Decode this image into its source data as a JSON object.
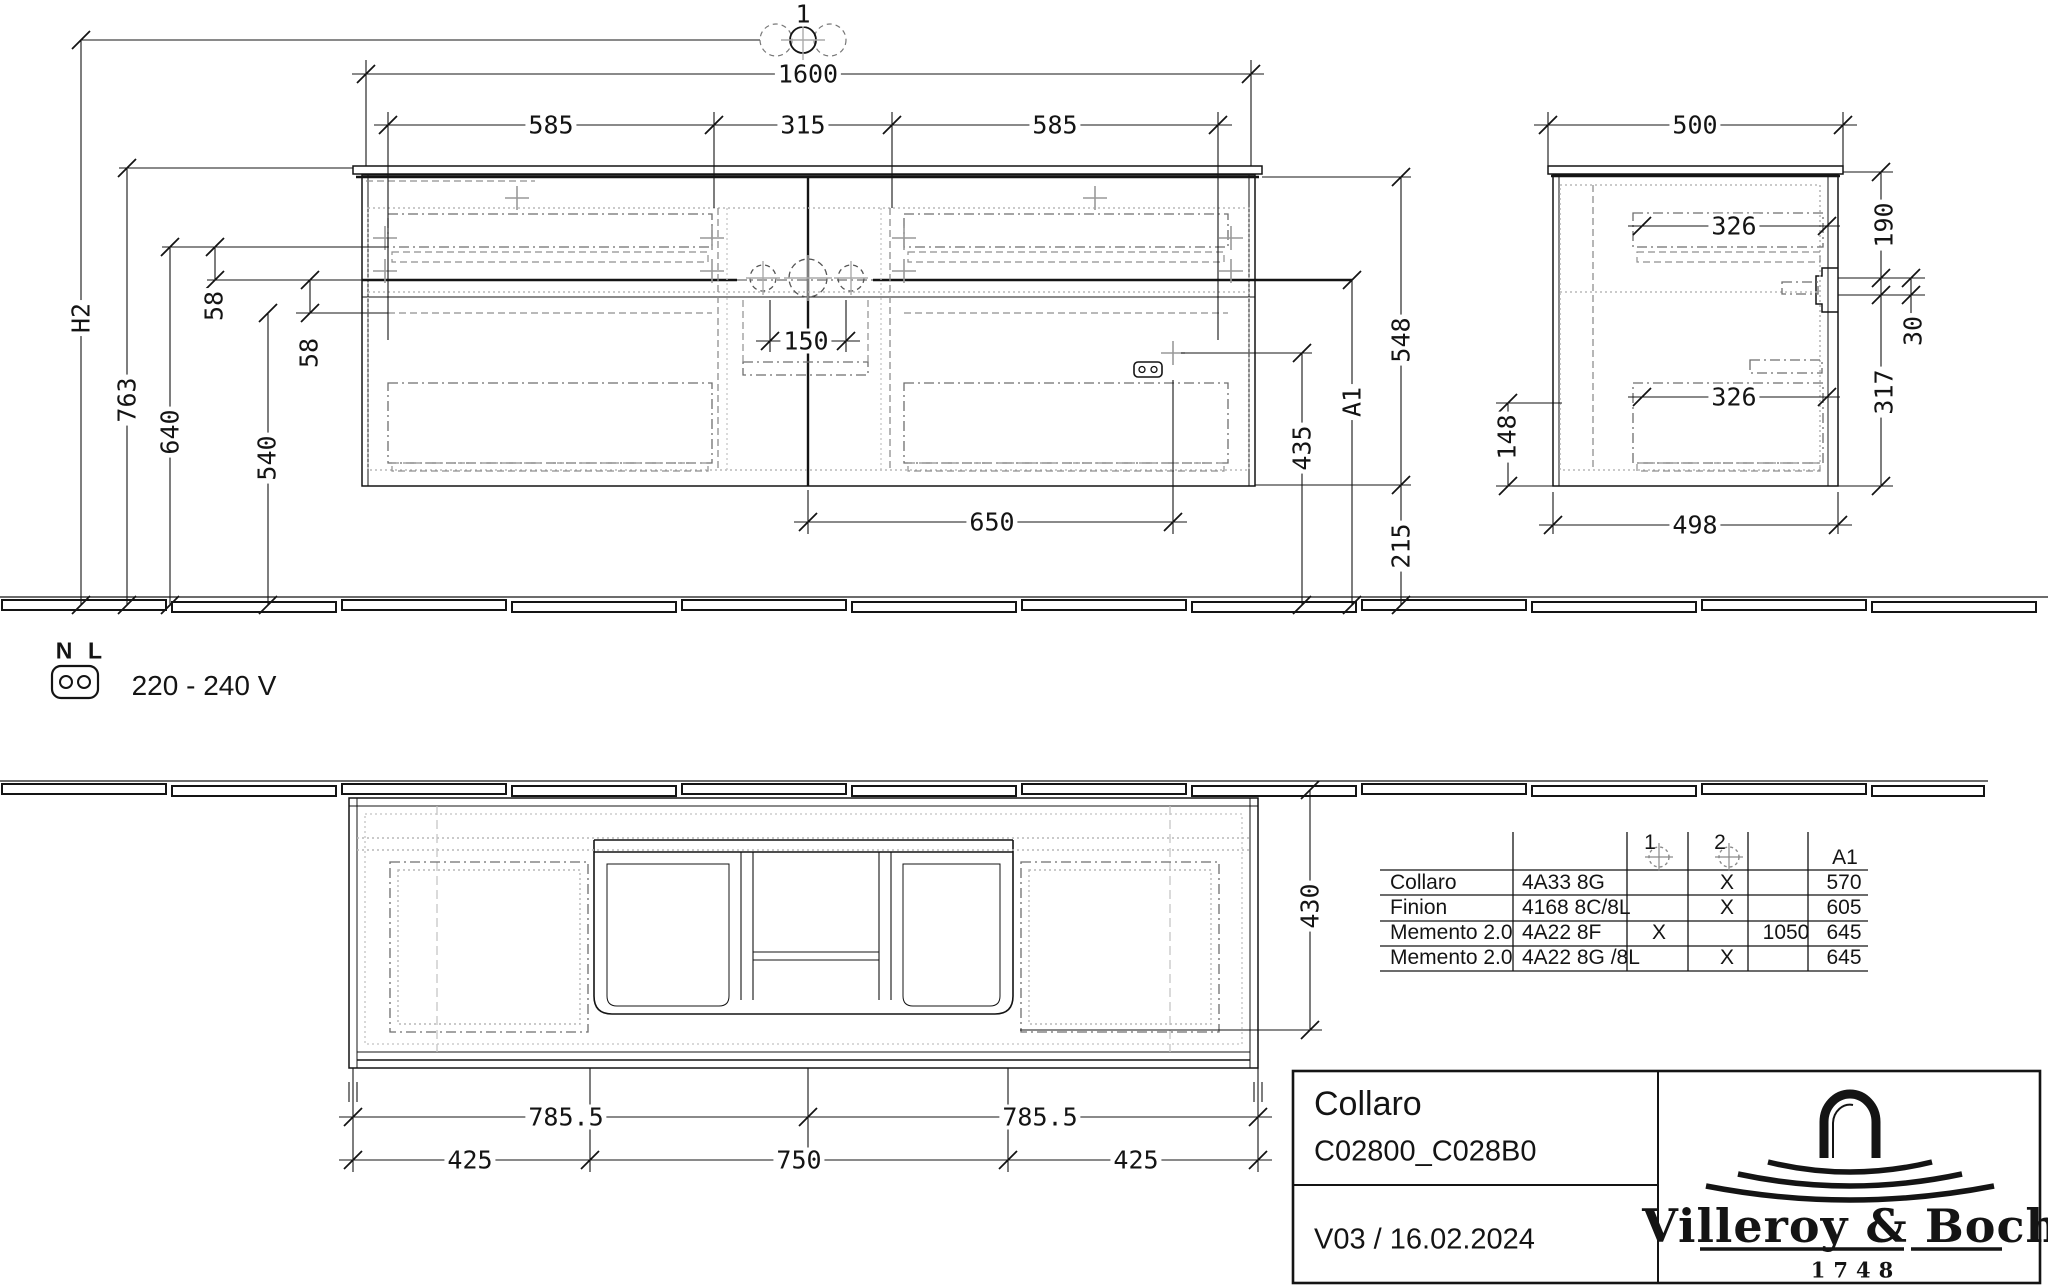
{
  "drawing": {
    "detail_marker": "1",
    "front_view": {
      "dims": {
        "total_width": "1600",
        "left_drawer": "585",
        "center_section": "315",
        "right_drawer": "585",
        "h2": "H2",
        "counter_height": "763",
        "h640": "640",
        "gap58_top": "58",
        "gap58_bottom": "58",
        "h540": "540",
        "faucet_spacing": "150",
        "socket_offset": "650",
        "socket_height": "435",
        "a1": "A1",
        "body_height": "548",
        "clearance": "215"
      }
    },
    "side_view": {
      "dims": {
        "total_depth": "500",
        "drawer_depth_top": "326",
        "drawer_depth_bottom": "326",
        "h190": "190",
        "h30": "30",
        "h317": "317",
        "h148": "148",
        "bottom_depth": "498"
      }
    },
    "plan_view": {
      "dims": {
        "basin_front": "430",
        "center_left": "785.5",
        "center_right": "785.5",
        "left": "425",
        "middle": "750",
        "right": "425"
      }
    },
    "power": {
      "n": "N",
      "l": "L",
      "voltage": "220 - 240 V"
    }
  },
  "table": {
    "headers": {
      "col1": "1",
      "col2": "2",
      "a1": "A1"
    },
    "rows": [
      {
        "name": "Collaro",
        "article": "4A33 8G",
        "col1": "",
        "col2": "X",
        "qty": "",
        "a1": "570"
      },
      {
        "name": "Finion",
        "article": "4168 8C/8L",
        "col1": "",
        "col2": "X",
        "qty": "",
        "a1": "605"
      },
      {
        "name": "Memento 2.0",
        "article": "4A22 8F",
        "col1": "X",
        "col2": "",
        "qty": "1050",
        "a1": "645"
      },
      {
        "name": "Memento 2.0",
        "article": "4A22 8G /8L",
        "col1": "",
        "col2": "X",
        "qty": "",
        "a1": "645"
      }
    ]
  },
  "title_block": {
    "product": "Collaro",
    "code": "C02800_C028B0",
    "version": "V03 / 16.02.2024",
    "brand": "Villeroy & Boch",
    "brand_year": "1748"
  }
}
